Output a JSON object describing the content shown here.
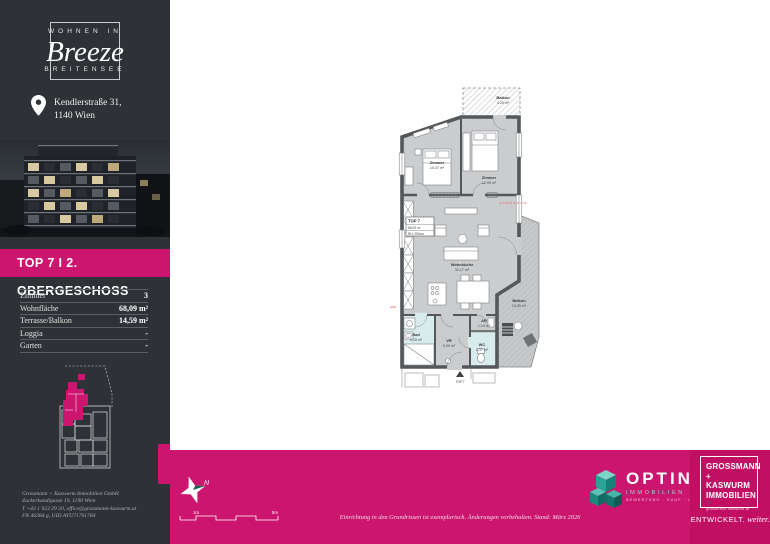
{
  "brand": {
    "logo_top": "WOHNEN IN",
    "logo_name": "Breeze",
    "logo_bottom": "BREITENSEE",
    "address_line1": "Kendlerstraße 31,",
    "address_line2": "1140 Wien"
  },
  "unit": {
    "banner": "TOP 7 I 2. OBERGESCHOSS",
    "facts": [
      {
        "label": "Zimmer",
        "value": "3"
      },
      {
        "label": "Wohnfläche",
        "value": "68,09 m²"
      },
      {
        "label": "Terrasse/Balkon",
        "value": "14,59 m²"
      },
      {
        "label": "Loggia",
        "value": "-"
      },
      {
        "label": "Garten",
        "value": "-"
      }
    ]
  },
  "floorplan": {
    "info_box": {
      "title": "TOP 7",
      "area": "68,09 m²",
      "room_height": "RH: 250cm"
    },
    "rooms": [
      {
        "name": "Balkon",
        "area": "4,20 m²"
      },
      {
        "name": "Zimmer",
        "area": "10,37 m²"
      },
      {
        "name": "Zimmer",
        "area": "12,99 m²"
      },
      {
        "name": "Wohnküche",
        "area": "32,17 m²"
      },
      {
        "name": "Balkon",
        "area": "10,39 m²"
      },
      {
        "name": "Bad",
        "area": "4,15 m²"
      },
      {
        "name": "VR",
        "area": "5,90 m²"
      },
      {
        "name": "AR",
        "area": "1,14 m²"
      },
      {
        "name": "WC",
        "area": "1,37 m²"
      }
    ],
    "entrance_label": "TOP 7"
  },
  "footer": {
    "north_label": "N",
    "scale": {
      "m1": "1m",
      "m5": "5m"
    },
    "disclaimer": "Einrichtung in den Grundrissen ist exemplarisch. Änderungen vorbehalten. Stand: März 2026",
    "optin": {
      "name": "OPTIN",
      "division": "IMMOBILIEN",
      "tagline": "BEWERTUNG · KAUF · INVEST"
    },
    "developer": {
      "line1": "GROSSMANN",
      "line2": "+ KASWURM",
      "line3": "IMMOBILIEN",
      "website": "grossmann-kaswurm.at",
      "claim_caps": "ENTWICKELT.",
      "claim_script": "weiter."
    }
  },
  "imprint": {
    "line1": "Grossmann + Kaswurm Immobilien GmbH",
    "line2": "Zuckerkandlgasse 19, 1190 Wien",
    "line3": "T +43 1 923 29 20, office@grossmann-kaswurm.at",
    "line4": "FN 46384 g, UID ATU71701784"
  },
  "colors": {
    "magenta": "#cc156e",
    "magenta_dark": "#c11064",
    "sidebar": "#2e3237"
  }
}
